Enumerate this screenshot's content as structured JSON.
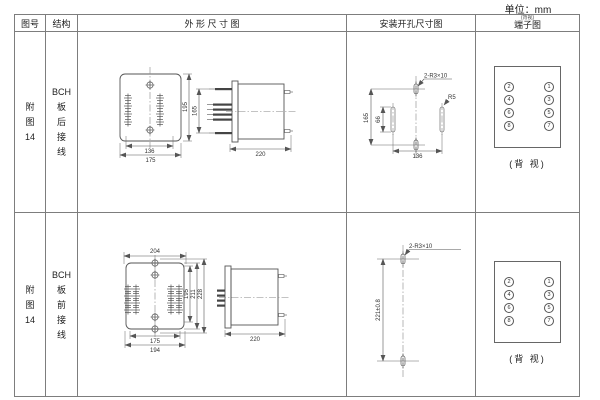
{
  "unit_label": "单位：mm",
  "headers": {
    "fig_no": "图号",
    "structure": "结构",
    "outline": "外 形 尺 寸 图",
    "mounting": "安装开孔尺寸图",
    "terminal": "端子图",
    "terminal_note": "(背视)"
  },
  "rows": [
    {
      "fig_no_chars": [
        "附",
        "图",
        "14"
      ],
      "structure_chars": [
        "BCH",
        "板",
        "后",
        "接",
        "线"
      ],
      "outline": {
        "hole_spacing": "136",
        "width": "175",
        "height": "195",
        "terminal_span": "165",
        "depth": "220"
      },
      "mounting": {
        "hole_height": "165",
        "slot_length": "66",
        "hole_width": "136",
        "slot_note": "2-R3×10",
        "radius_note": "R5"
      },
      "terminal": {
        "left": [
          "2",
          "4",
          "6",
          "8"
        ],
        "right": [
          "1",
          "3",
          "5",
          "7"
        ],
        "view_note": "(背 视)"
      }
    },
    {
      "fig_no_chars": [
        "附",
        "图",
        "14"
      ],
      "structure_chars": [
        "BCH",
        "板",
        "前",
        "接",
        "线"
      ],
      "outline": {
        "top_width": "204",
        "inner_height": "195",
        "mid_height": "211",
        "height": "228",
        "bottom_inner_width": "175",
        "bottom_width": "194",
        "depth": "220"
      },
      "mounting": {
        "hole_spacing": "221±0.8",
        "slot_note": "2-R3×10"
      },
      "terminal": {
        "left": [
          "2",
          "4",
          "6",
          "8"
        ],
        "right": [
          "1",
          "3",
          "5",
          "7"
        ],
        "view_note": "(背 视)"
      }
    }
  ]
}
